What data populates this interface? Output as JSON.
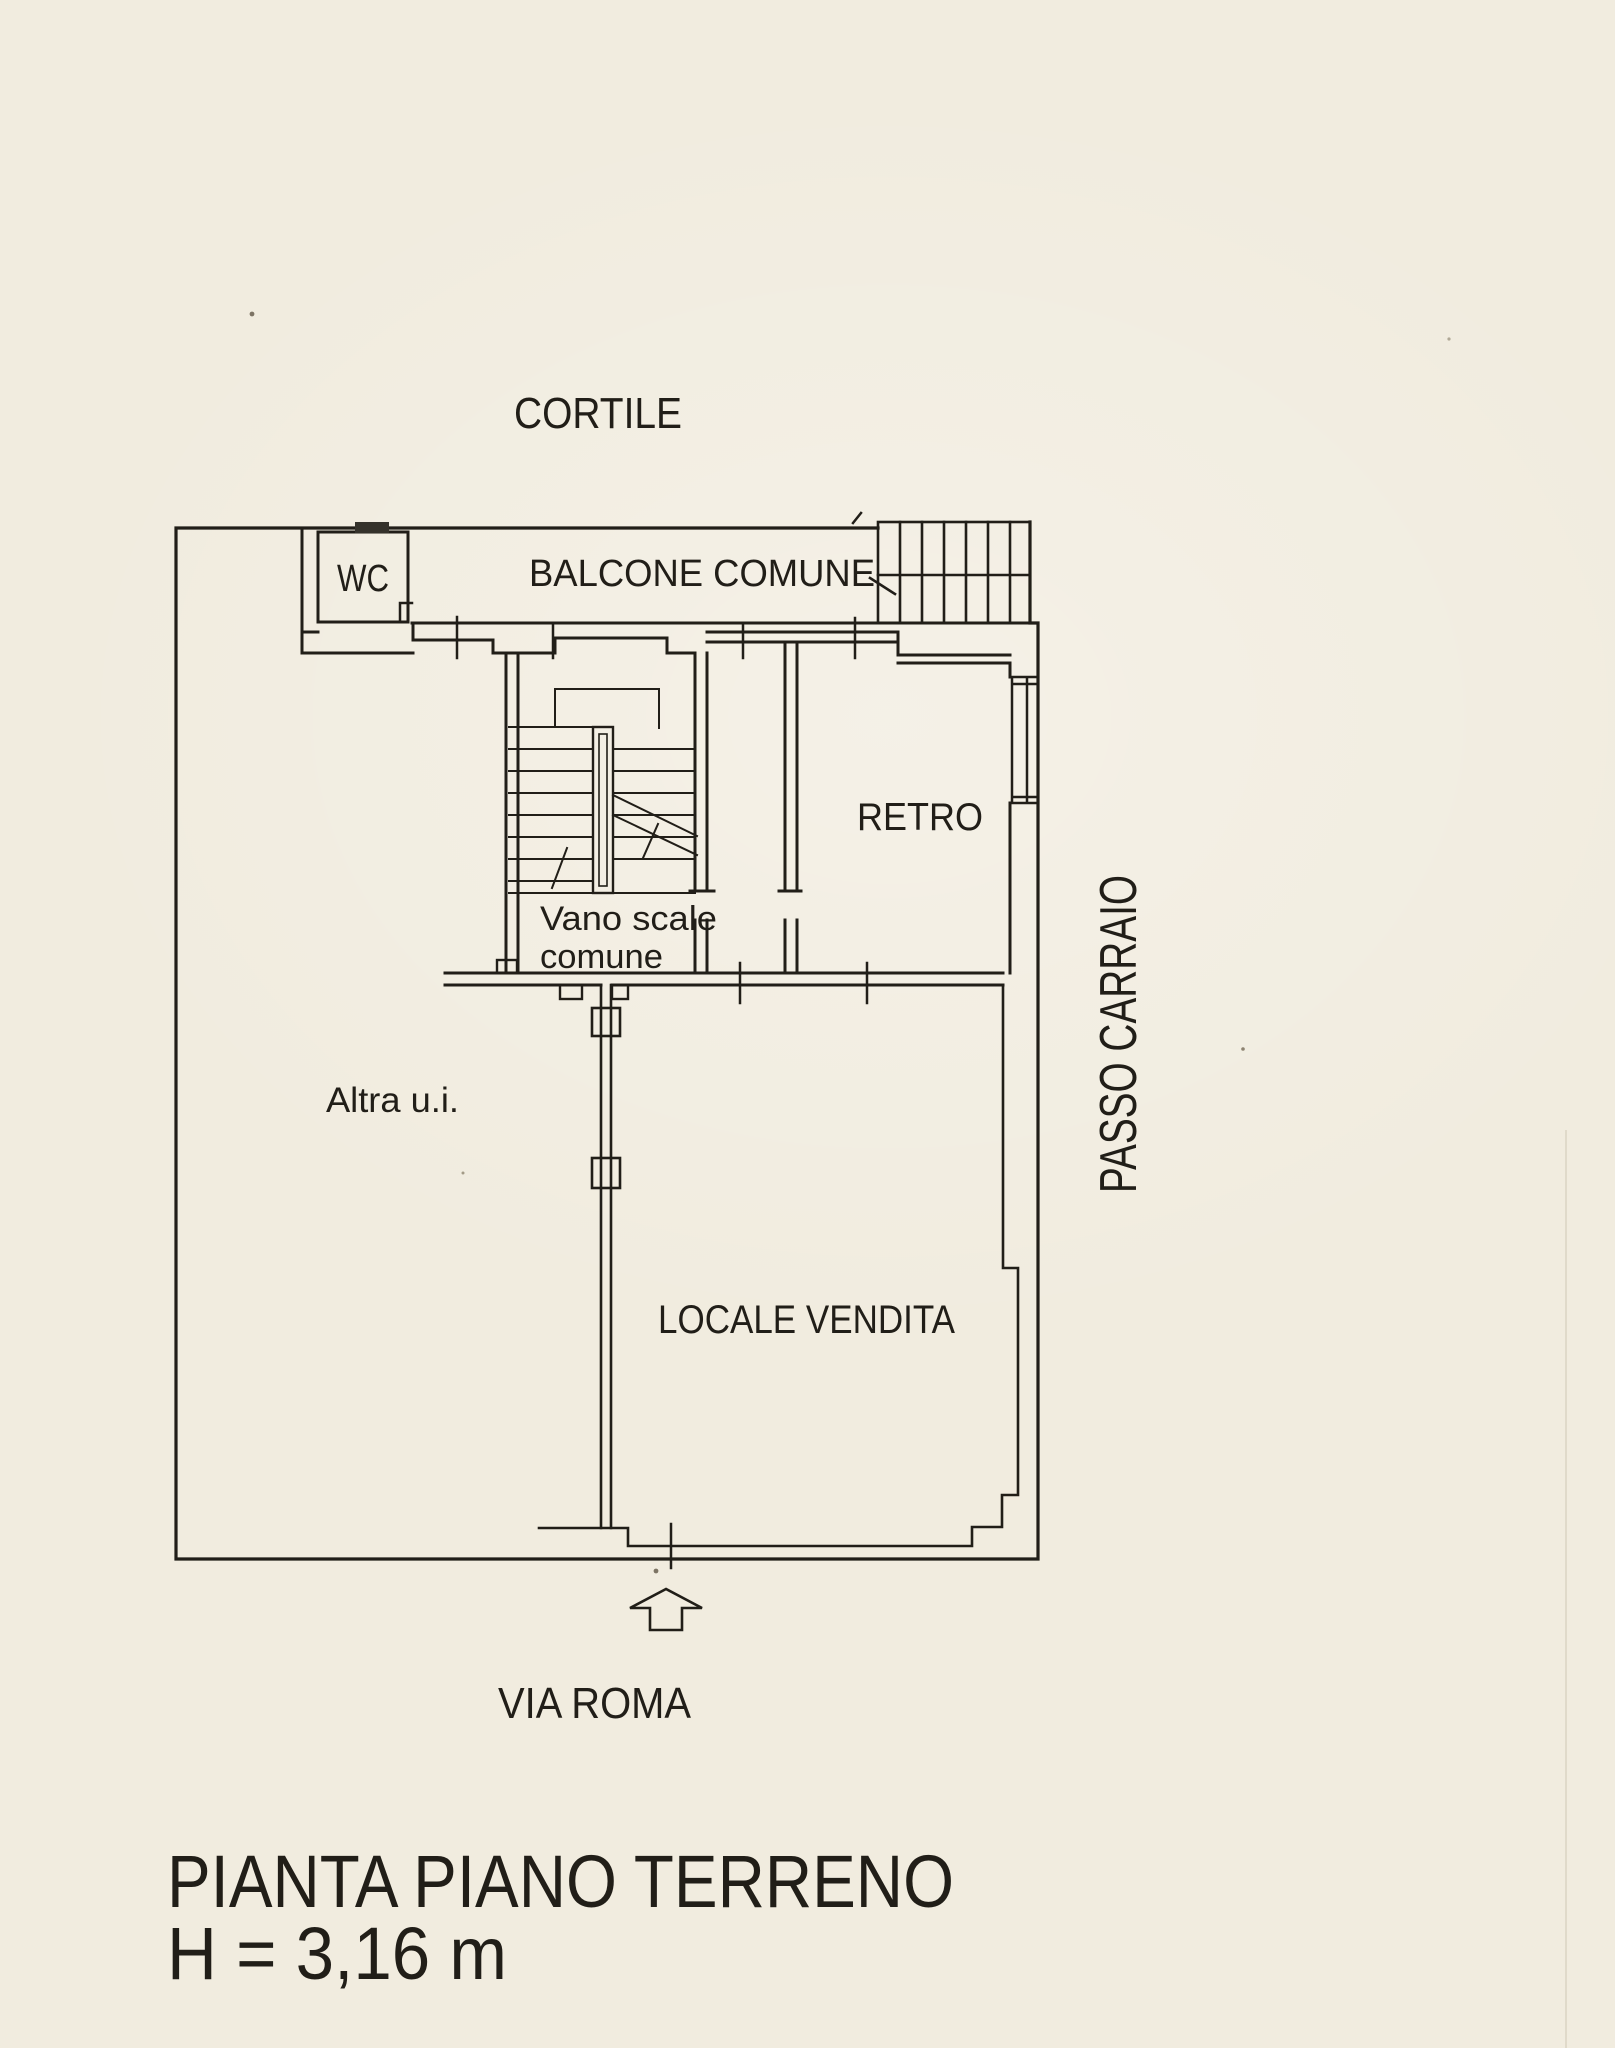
{
  "plan": {
    "surroundings": {
      "courtyard": "CORTILE",
      "driveway": "PASSO CARRAIO",
      "street": "VIA ROMA"
    },
    "rooms": {
      "wc": "WC",
      "balcony": "BALCONE COMUNE",
      "stairwell_line1": "Vano scale",
      "stairwell_line2": "comune",
      "back_room": "RETRO",
      "other_unit": "Altra u.i.",
      "sales_room": "LOCALE VENDITA"
    },
    "title": {
      "line1": "PIANTA PIANO TERRENO",
      "line2": "H = 3,16 m"
    },
    "colors": {
      "paper": "#f1ecdf",
      "ink": "#211e18"
    }
  }
}
